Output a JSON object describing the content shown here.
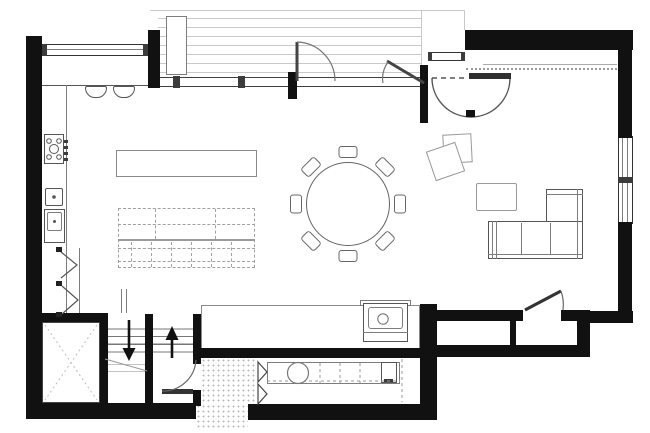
{
  "palette": {
    "wall": "#111111",
    "dark": "#3c3c3c",
    "mid": "#7d7d7d",
    "light": "#c9c9c9",
    "dash": "#a0a0a0",
    "paper": "#ffffff"
  },
  "plan": {
    "drawing_type": "residential-floor-plan-main-level",
    "exterior_features": [
      "deck-with-board-lines",
      "deck-planter",
      "entry-porch",
      "tiled-entry-step"
    ],
    "openings": [
      "top-left-window",
      "glass-wall-with-mullions",
      "deck-door-swing",
      "deck-door-ajar",
      "entry-window",
      "entry-door-semicircle-swing",
      "right-wall-double-window",
      "stair-hall-door",
      "mudroom-door-ajar",
      "pantry-bifold-doors"
    ],
    "kitchen": [
      "breakfast-bar-counter",
      "two-bar-stools",
      "range-cooktop-4-burners",
      "oven-unit",
      "single-basin-sink",
      "tall-appliance",
      "kitchen-island"
    ],
    "living": [
      "dashed-modular-sofa",
      "round-dining-table",
      "eight-dining-chairs",
      "two-tilted-ottomans",
      "coffee-table",
      "l-shaped-sectional-sofa"
    ],
    "service": [
      "elevator-shaft-x",
      "stair-flight-down",
      "stair-flight-up",
      "down-arrow",
      "up-arrow",
      "utility-sink-console",
      "laundry-counter",
      "washing-machine",
      "small-appliance",
      "tiled-vestibule"
    ]
  }
}
